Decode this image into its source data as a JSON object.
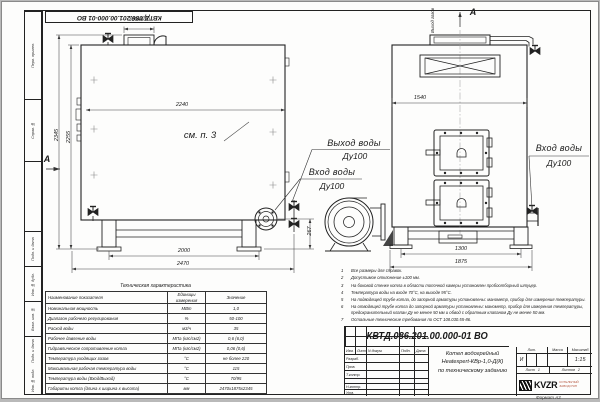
{
  "sheet": {
    "stamp_top": "КВТД.086.201.00.000-01 ВО",
    "format_note": "Формат А3",
    "side_fields": [
      "Перв. примен.",
      "Справ. №",
      "Подп. и дата",
      "Инв. № дубл.",
      "Взам. инв. №",
      "Подп. и дата",
      "Инв. № подл."
    ]
  },
  "side_view": {
    "section_label": "А",
    "note_ref": "см. п. 3",
    "dims": {
      "duct": "300х600",
      "top_width": "2240",
      "height_outer": "2345",
      "height_inner": "2255",
      "base_inner": "2000",
      "base_outer": "2470",
      "flange_height": "267"
    }
  },
  "front_view": {
    "view_label": "А",
    "gas_outlet": "Выход газов",
    "dims": {
      "top_width": "1540",
      "base_inner": "1300",
      "base_outer": "1875"
    }
  },
  "labels": {
    "outlet_line1": "Выход воды",
    "outlet_line2": "Ду100",
    "inlet_line1": "Вход воды",
    "inlet_line2": "Ду100",
    "inlet_right_line1": "Вход воды",
    "inlet_right_line2": "Ду100"
  },
  "notes": {
    "items": [
      {
        "num": "1",
        "text": "Все размеры для справок."
      },
      {
        "num": "2",
        "text": "Допустимое отклонение ±100 мм."
      },
      {
        "num": "3",
        "text": "На боковой стенке котла в области топочной камеры установлен пробоотборный штуцер."
      },
      {
        "num": "4",
        "text": "Температура воды на входе 70°С, на выходе 95°С."
      },
      {
        "num": "5",
        "text": "На  подводящей трубе котла, до запорной арматуры установлены: манометр, прибор для измерения температуры."
      },
      {
        "num": "6",
        "text": "На отводящей трубе котла до запорной арматуры установлены: манометр, прибор для измерения температуры, предохранительный клапан Ду не менее 50 мм и обвод с обратным клапаном Ду не менее 50 мм."
      },
      {
        "num": "7",
        "text": "Остальные технические требования по ОСТ 108.030.55-86."
      }
    ]
  },
  "spec_table": {
    "title": "Техническая характеристика",
    "headers": [
      "Наименование показателя",
      "Единицы измерения",
      "Значение"
    ],
    "rows": [
      [
        "Номинальная мощность",
        "МВт",
        "1,0"
      ],
      [
        "Диапазон рабочего регулирования",
        "%",
        "50-100"
      ],
      [
        "Расход воды",
        "м3/ч",
        "35"
      ],
      [
        "Рабочее давление воды",
        "МПа (кгс/см2)",
        "0,6 (6,0)"
      ],
      [
        "Гидравлическое сопротивление котла",
        "МПа (кгс/см2)",
        "0,06 (0,6)"
      ],
      [
        "Температура уходящих газов",
        "°С",
        "не более 220"
      ],
      [
        "Максимальная рабочая температура воды",
        "°С",
        "115"
      ],
      [
        "Температура воды (Вход/Выход)",
        "°С",
        "70/95"
      ],
      [
        "Габариты котла (длина х ширина х высота)",
        "мм",
        "2470х1875х2345"
      ]
    ]
  },
  "title_block": {
    "designation": "КВТД.086.201.00.000-01  ВО",
    "name_line1": "Котел водогрейный",
    "name_line2": "Heatexpert-КВр-1,0-Д(К)",
    "name_line3": "по техническому заданию",
    "col_izm": "Изм.",
    "col_list": "Лист",
    "col_doc": "N докум.",
    "col_sign": "Подп.",
    "col_date": "Дата",
    "role_dev": "Разраб.",
    "role_check": "Пров.",
    "role_tcontr": "Т.контр.",
    "role_ncontr": "Н.контр.",
    "role_approve": "Утв.",
    "lit_label": "Лит.",
    "lit_value": "И",
    "mass_label": "Масса",
    "scale_label": "Масштаб",
    "scale_value": "1:15",
    "sheet_label": "Лист",
    "sheet_value": "1",
    "sheets_label": "Листов",
    "sheets_value": "2",
    "logo_text": "KVZR",
    "company_line1": "КОТЕЛЬНЫЙ",
    "company_line2": "ЗАВОД РЭП"
  }
}
